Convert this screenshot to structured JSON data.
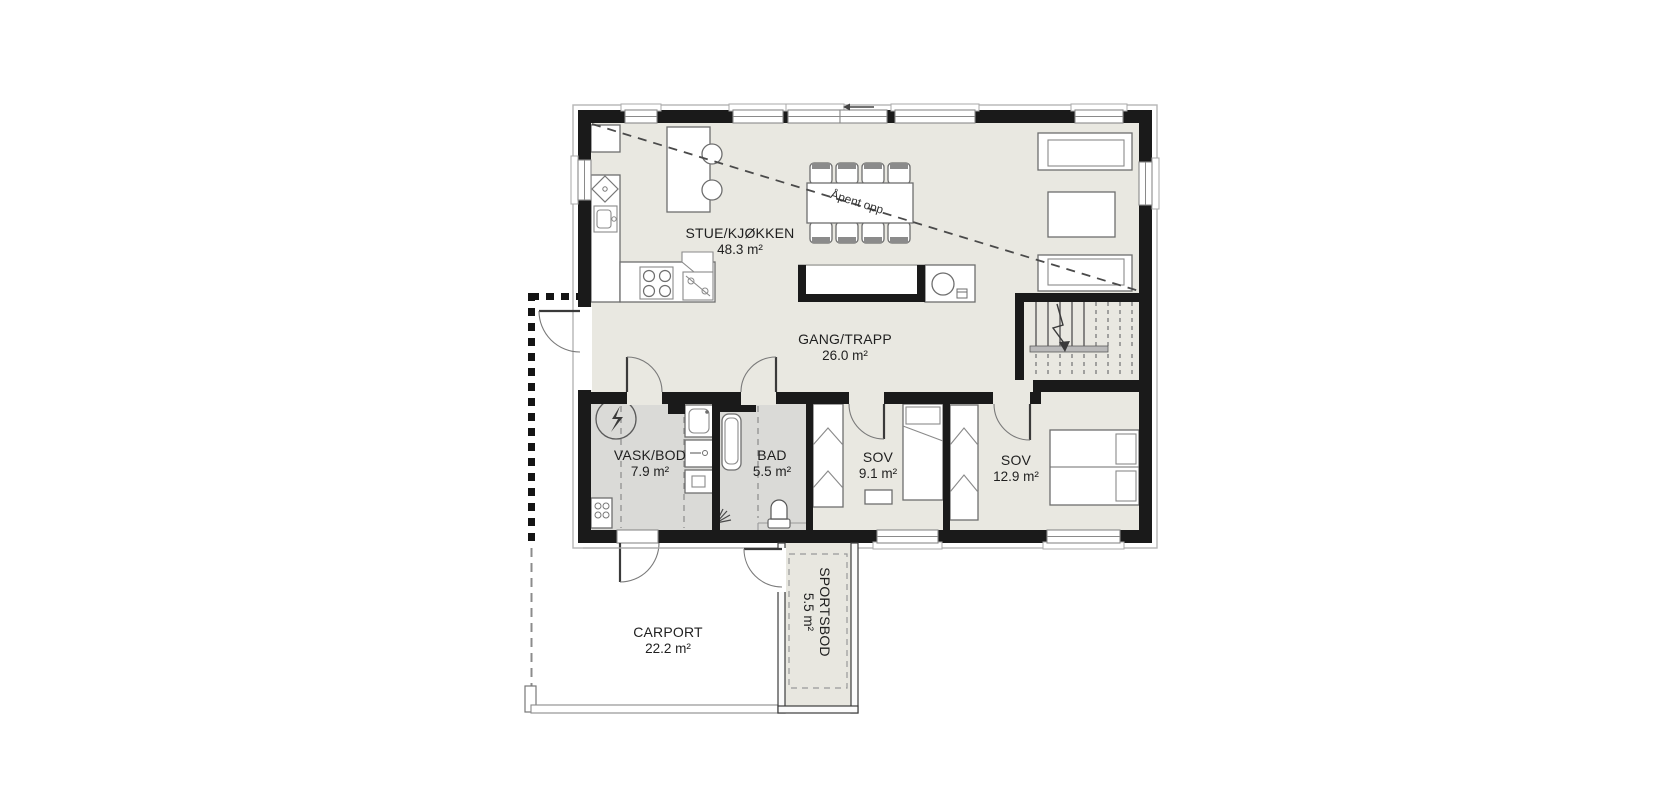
{
  "plan": {
    "rooms": [
      {
        "name": "STUE/KJØKKEN",
        "area": "48.3 m²"
      },
      {
        "name": "GANG/TRAPP",
        "area": "26.0 m²"
      },
      {
        "name": "VASK/BOD",
        "area": "7.9 m²"
      },
      {
        "name": "BAD",
        "area": "5.5 m²"
      },
      {
        "name": "SOV",
        "area": "9.1 m²"
      },
      {
        "name": "SOV",
        "area": "12.9 m²"
      },
      {
        "name": "CARPORT",
        "area": "22.2 m²"
      },
      {
        "name": "SPORTSBOD",
        "area": "5.5 m²"
      }
    ],
    "annotations": {
      "open_to_above": "Åpent opp"
    },
    "fixtures": [
      "electrical-panel-icon",
      "dishwasher-icon",
      "kitchen-sink-icon",
      "stove-icon",
      "corner-cabinet-icon",
      "fridge-cabinet",
      "kitchen-island",
      "bar-stool",
      "dining-table",
      "dining-chair",
      "water-heater-icon",
      "sofa",
      "coffee-table",
      "stairs",
      "washing-machine-icon",
      "dryer-icon",
      "cabinet-icon",
      "utility-sink-icon",
      "bathtub-icon",
      "shower-icon",
      "toilet-icon",
      "wardrobe",
      "single-bed",
      "double-bed",
      "nightstand",
      "carport-post"
    ],
    "colors": {
      "wall": "#1a1a1a",
      "floor": "#e9e8e1",
      "wet_room_floor": "#dadad7",
      "background": "#ffffff",
      "furniture_stroke": "#6e6e6e"
    }
  }
}
